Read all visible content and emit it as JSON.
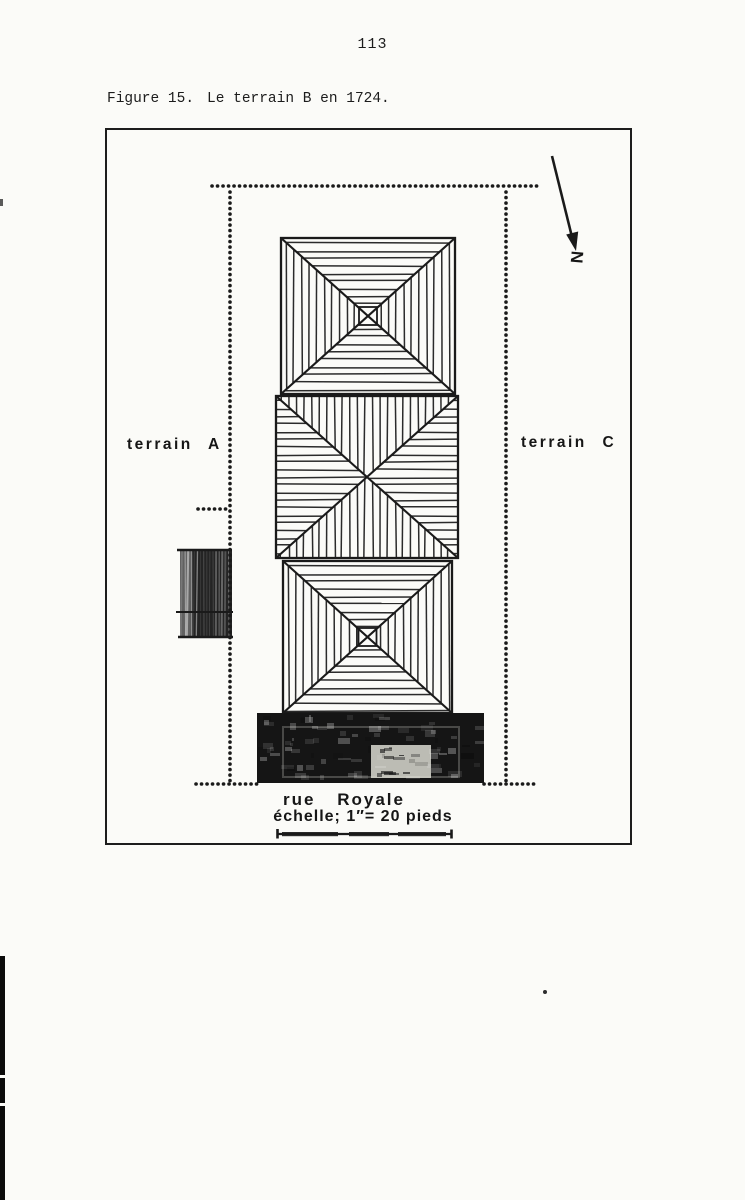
{
  "page": {
    "number": "113"
  },
  "caption": {
    "label": "Figure 15.",
    "title": "Le terrain B en 1724."
  },
  "plan": {
    "terrain_left": "terrain A",
    "terrain_right": "terrain C",
    "street": "rue Royale",
    "scale_text": "échelle; 1″= 20 pieds",
    "north": "N"
  },
  "colors": {
    "ink": "#1a1a1a",
    "paper": "#fbfbf8"
  }
}
